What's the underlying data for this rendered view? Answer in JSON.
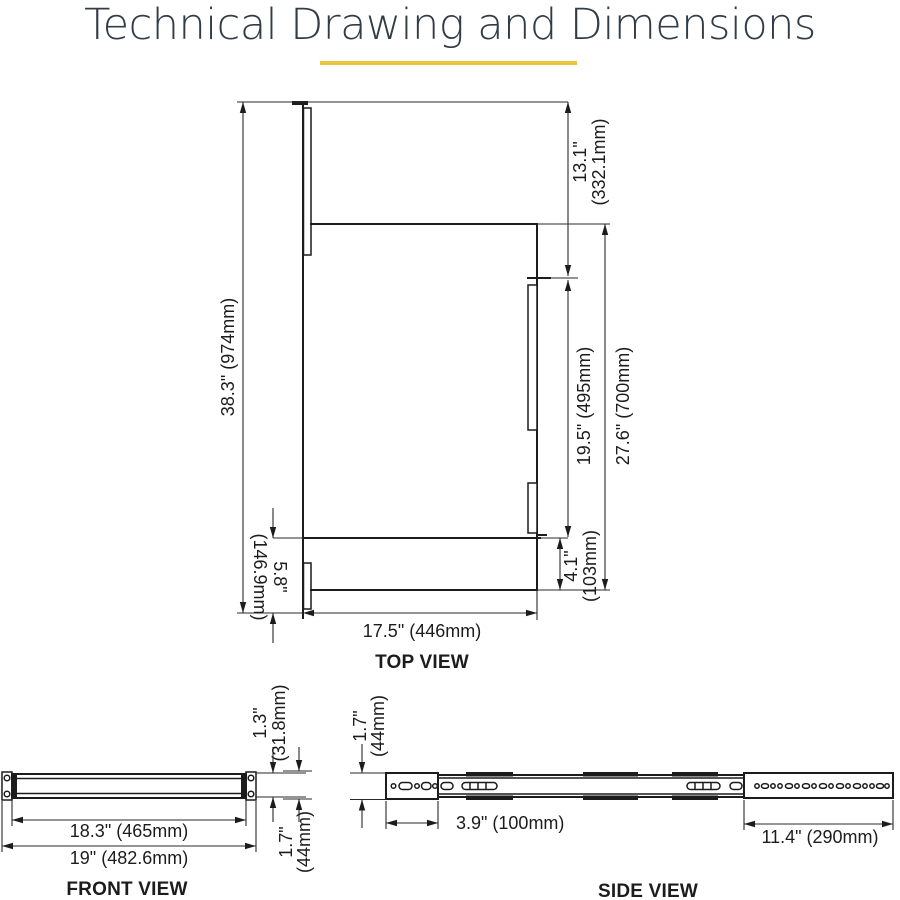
{
  "title": "Technical Drawing and Dimensions",
  "accent_color": "#e8c63f",
  "views": {
    "top": {
      "label": "TOP VIEW",
      "dims": {
        "overall_depth": "38.3\" (974mm)",
        "extension_in": "13.1\"",
        "extension_mm": "(332.1mm)",
        "shelf_depth": "19.5\" (495mm)",
        "total_depth": "27.6\" (700mm)",
        "rear_gap_in": "4.1\"",
        "rear_gap_mm": "(103mm)",
        "front_gap_in": "5.8\"",
        "front_gap_mm": "(146.9mm)",
        "width": "17.5\" (446mm)"
      }
    },
    "front": {
      "label": "FRONT VIEW",
      "dims": {
        "flange_in": "1.3\"",
        "flange_mm": "(31.8mm)",
        "height_in": "1.7\"",
        "height_mm": "(44mm)",
        "body_width": "18.3\" (465mm)",
        "overall_width": "19\" (482.6mm)"
      }
    },
    "side": {
      "label": "SIDE VIEW",
      "dims": {
        "height_in": "1.7\"",
        "height_mm": "(44mm)",
        "bracket_length": "3.9\" (100mm)",
        "rail_length": "11.4\" (290mm)"
      }
    }
  }
}
